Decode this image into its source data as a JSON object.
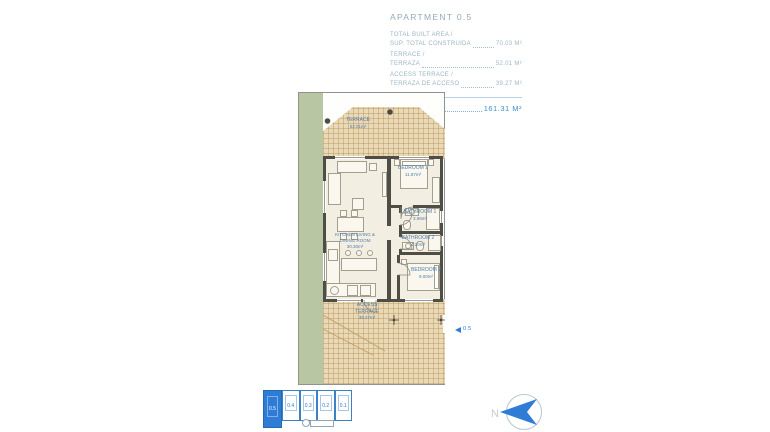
{
  "header": {
    "title": "APARTMENT 0.5",
    "areas": [
      {
        "label_en": "TOTAL BUILT AREA /",
        "label_es": "SUP. TOTAL CONSTRUIDA",
        "value": "70.03 M²"
      },
      {
        "label_en": "TERRACE /",
        "label_es": "TERRAZA",
        "value": "52.01 M²"
      },
      {
        "label_en": "ACCESS TERRACE /",
        "label_es": "TERRAZA DE ACCESO",
        "value": "39.27 M²"
      }
    ],
    "total_label": "TOTAL",
    "total_value": "161.31 M²"
  },
  "plan": {
    "terrace": {
      "name": "TERRACE",
      "area": "52.01m²"
    },
    "bedroom1": {
      "name": "BEDROOM 1",
      "area": "11.87m²"
    },
    "bathroom1": {
      "name": "BATHROOM 1",
      "area": "3.99m²"
    },
    "bathroom2": {
      "name": "BATHROOM 2",
      "area": "4.20m²"
    },
    "bedroom2": {
      "name": "BEDROOM 2",
      "area": "9.00m²"
    },
    "kitchen": {
      "name": "KITCHEN LIVING & DINING ROOM",
      "area": "30.30m²"
    },
    "access_terrace": {
      "name": "ACCESS TERRACE",
      "area": "39.27m²"
    },
    "entry_label": "0.5"
  },
  "keyplan": {
    "units": [
      {
        "label": "0.5",
        "selected": true
      },
      {
        "label": "0.4",
        "selected": false
      },
      {
        "label": "0.3",
        "selected": false
      },
      {
        "label": "0.2",
        "selected": false
      },
      {
        "label": "0.1",
        "selected": false
      }
    ]
  },
  "compass": {
    "north_label": "N"
  },
  "colors": {
    "accent_blue": "#2e7cd6",
    "label_blue": "#4f7fae",
    "total_blue": "#3f8cc4",
    "terrace_tan": "#ead9b6",
    "garden_green": "#b8c6a3",
    "wall_gray": "#4e4e46"
  }
}
